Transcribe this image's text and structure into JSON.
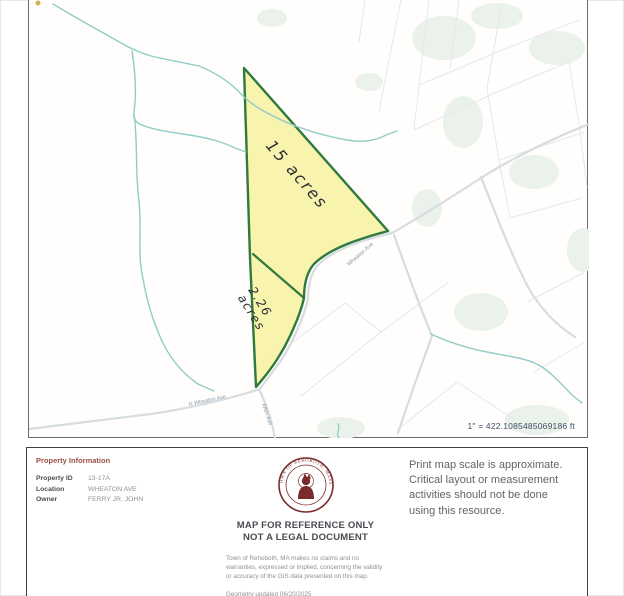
{
  "map": {
    "scale_text": "1\" = 422.1085485069186 ft",
    "parcel": {
      "area_label_large": "15 acres",
      "area_label_small_line1": "2.26",
      "area_label_small_line2": "acres",
      "fill_color": "#f6f09b",
      "outline_color": "#2f7a3d"
    },
    "roads": [
      {
        "label": "Wheaton Ave"
      },
      {
        "label": "N Wheaton Ave"
      },
      {
        "label": "Allen Ave"
      }
    ],
    "colors": {
      "stream": "#8fcdc7",
      "road": "#d6dcdf",
      "wetland": "#ebf1eb",
      "parcel_line": "#e3e8ec"
    }
  },
  "footer": {
    "property_info": {
      "title": "Property Information",
      "rows": [
        {
          "label": "Property ID",
          "value": "13-17A"
        },
        {
          "label": "Location",
          "value": "WHEATON AVE"
        },
        {
          "label": "Owner",
          "value": "FERRY JR, JOHN"
        }
      ]
    },
    "disclaimer": {
      "seal_ring_text": "TOWN OF REHOBOTH, MASS.",
      "seal_color": "#7b2b2b",
      "heading_line1": "MAP FOR REFERENCE ONLY",
      "heading_line2": "NOT A LEGAL DOCUMENT",
      "body": "Town of Rehoboth, MA makes no claims and no warranties, expressed or implied, concerning the validity or accuracy of the GIS data presented on this map.",
      "geometry_updated": "Geometry updated 06/20/2025",
      "data_updated": "Data updated 06/20/2025"
    },
    "scale_note": "Print map scale is approximate. Critical layout or measurement activities should not be done using this resource."
  }
}
